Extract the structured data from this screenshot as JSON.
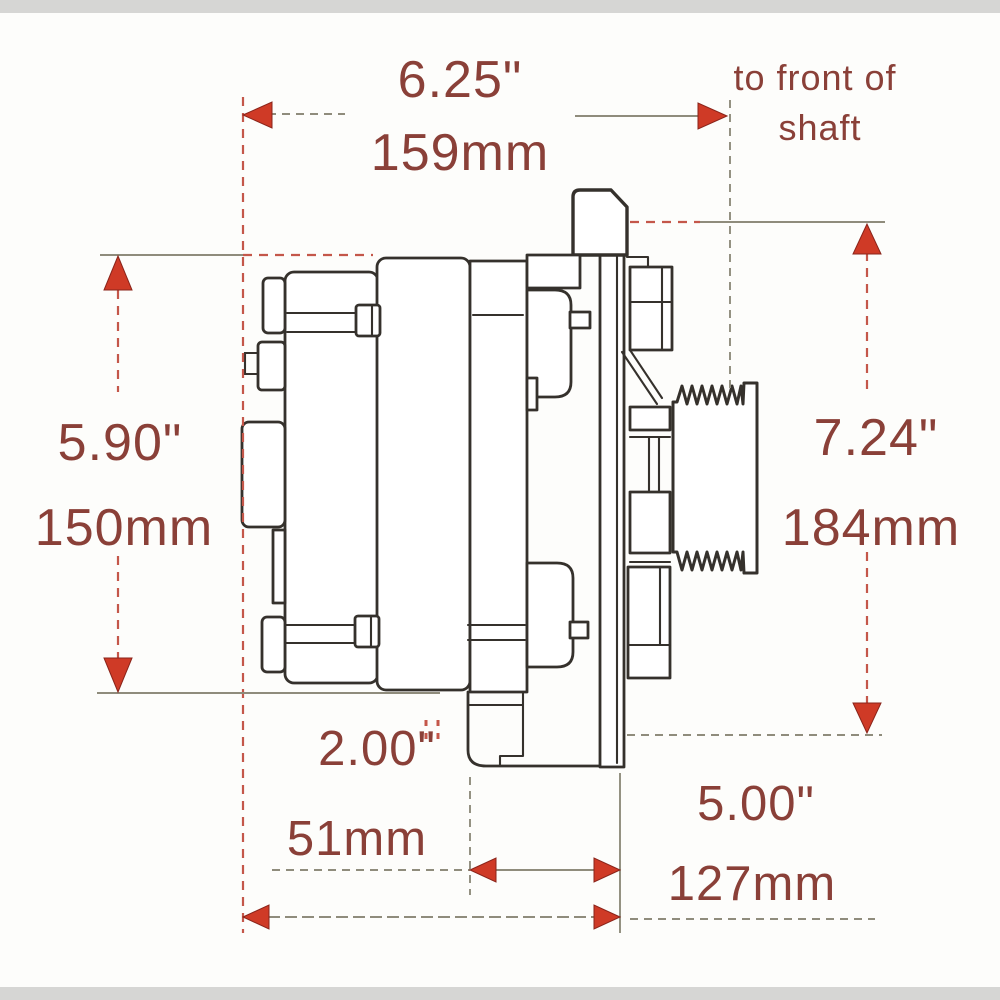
{
  "page": {
    "description": "Alternator side-view dimensional drawing"
  },
  "colors": {
    "background": "#fdfdfb",
    "scan_bar": "#d6d6d4",
    "line": "#35312c",
    "dimension_text": "#8a4038",
    "arrow": "#cf3a26",
    "extension_gray": "#8f8c7c",
    "extension_red": "#c4574a"
  },
  "dimensions": {
    "overall_length_in": "6.25\"",
    "overall_length_mm": "159mm",
    "shaft_note_line1": "to front of",
    "shaft_note_line2": "shaft",
    "body_height_in": "5.90\"",
    "body_height_mm": "150mm",
    "overall_height_in": "7.24\"",
    "overall_height_mm": "184mm",
    "foot_length_in": "2.00\"",
    "foot_length_mm": "51mm",
    "rear_to_flange_in": "5.00\"",
    "rear_to_flange_mm": "127mm"
  }
}
